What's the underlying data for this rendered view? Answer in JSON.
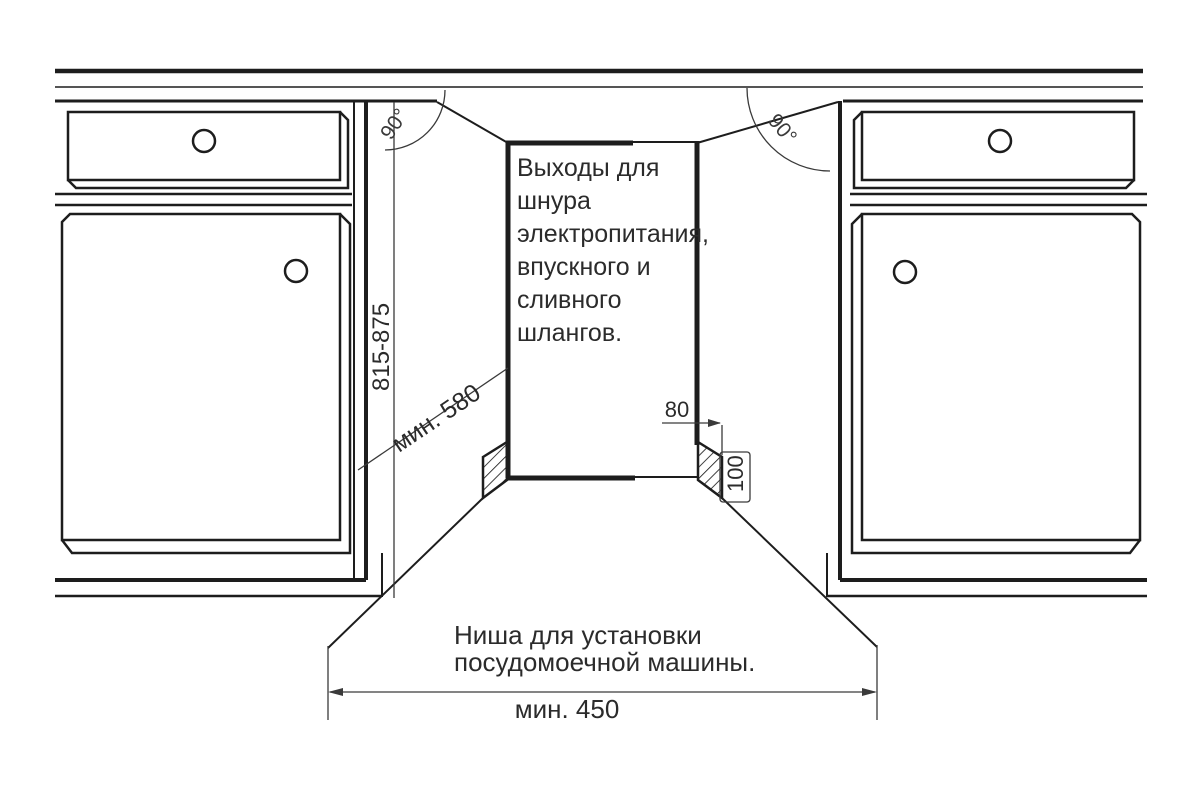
{
  "diagram": {
    "outlet_note": {
      "text": "Выходы для шнура электропитания, впускного и сливного шлангов.",
      "lines": [
        "Выходы для",
        "шнура",
        "электропитания,",
        "впускного и",
        "сливного",
        "шлангов."
      ]
    },
    "niche_label": {
      "text": "Ниша для установки посудомоечной машины.",
      "lines": [
        "Ниша для установки",
        "посудомоечной машины."
      ]
    },
    "dimensions": {
      "height_range": "815-875",
      "min_depth": "мин. 580",
      "min_width": "мин. 450",
      "outlet_offset": "80",
      "outlet_zone_height": "100",
      "angle_left": "90°",
      "angle_right": "90°"
    },
    "colors": {
      "line": "#1d1d1d",
      "dimension_line": "#3a3a3a",
      "text": "#2b2b2b",
      "background": "#ffffff"
    }
  }
}
